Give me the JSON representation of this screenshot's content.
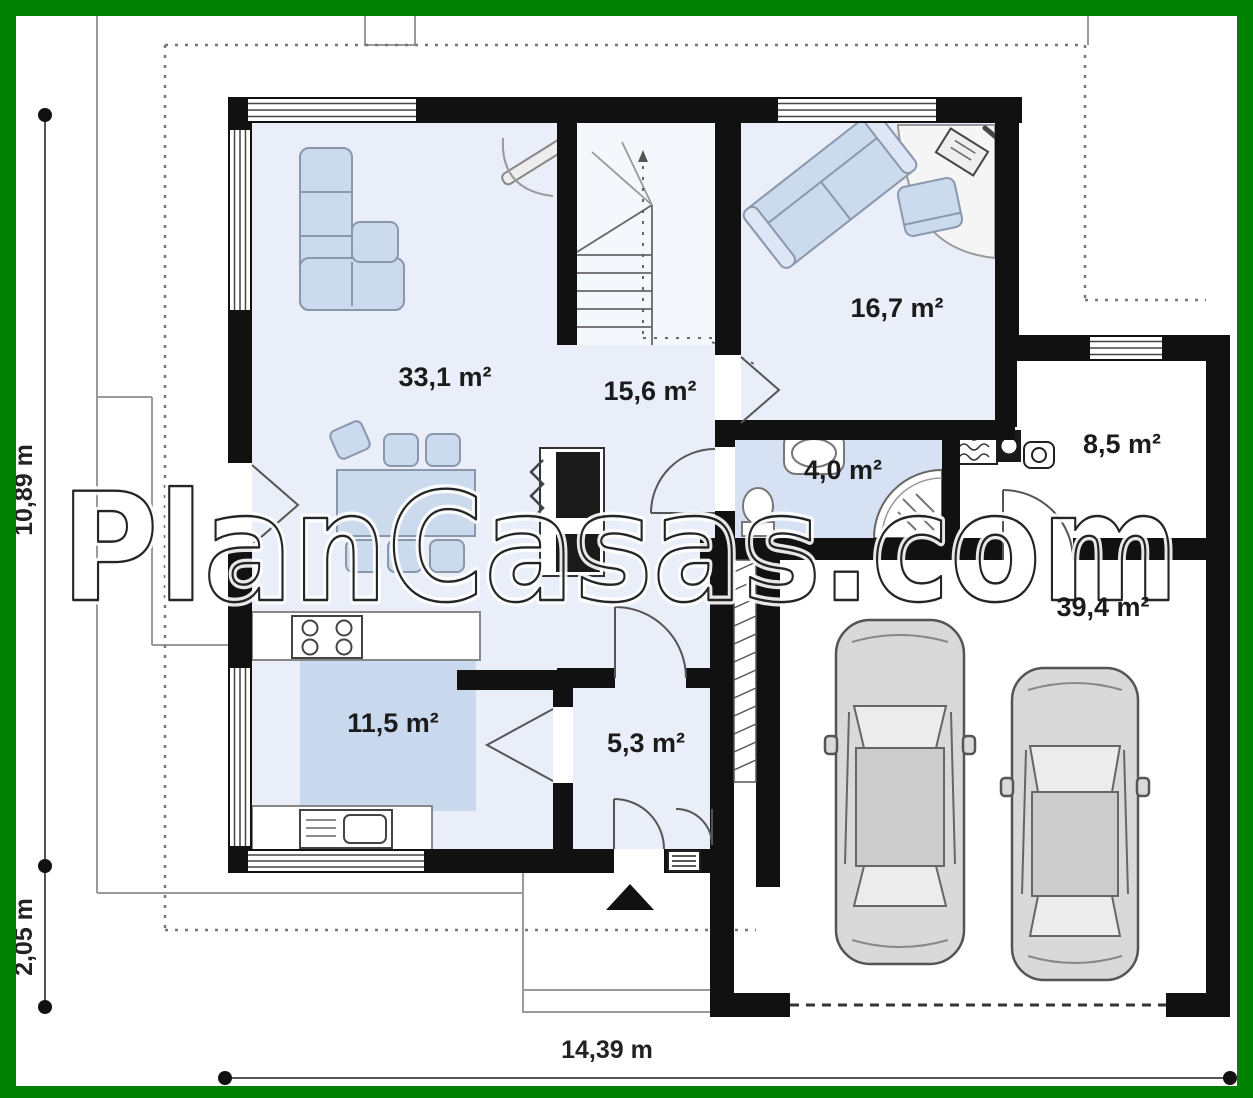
{
  "frame": {
    "color": "#008000"
  },
  "watermark": {
    "text": "PlanCasas.com"
  },
  "plan": {
    "rooms": {
      "living_dining": {
        "label": "33,1 m²"
      },
      "hall": {
        "label": "15,6 m²"
      },
      "salon": {
        "label": "16,7 m²"
      },
      "bathroom": {
        "label": "4,0 m²"
      },
      "storage": {
        "label": "8,5 m²"
      },
      "garage": {
        "label": "39,4 m²"
      },
      "kitchen": {
        "label": "11,5 m²"
      },
      "entry_hall": {
        "label": "5,3 m²"
      }
    },
    "dimensions": {
      "height_total": "10,89 m",
      "height_porch": "2,05 m",
      "width_total": "14,39 m"
    },
    "colors": {
      "frame_green": "#008000",
      "wall_black": "#111111",
      "floor_blue": "#e9eef8",
      "bathroom_blue": "#d6e2f3",
      "rug_blue": "#c9d9ee",
      "furniture_blue": "#ccdaee",
      "car_gray": "#d9d9d9"
    }
  }
}
